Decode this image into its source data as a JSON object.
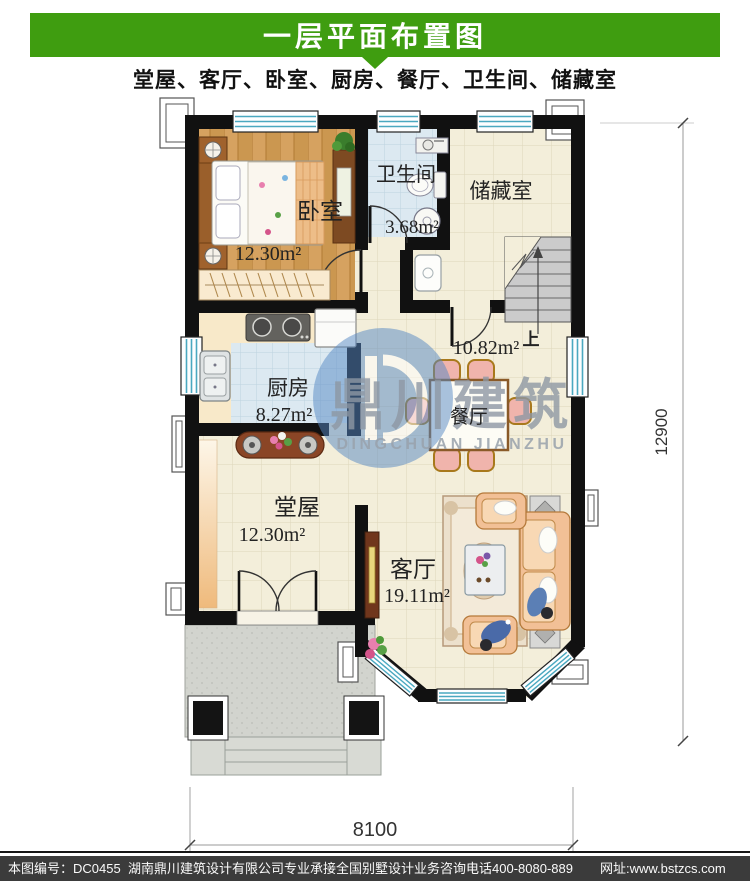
{
  "header": {
    "title": "一层平面布置图",
    "subtitle": "堂屋、客厅、卧室、厨房、餐厅、卫生间、储藏室"
  },
  "rooms": {
    "bedroom": {
      "name": "卧室",
      "area": "12.30m²"
    },
    "bathroom": {
      "name": "卫生间",
      "area": "3.68m²"
    },
    "storage": {
      "name": "储藏室"
    },
    "kitchen": {
      "name": "厨房",
      "area": "8.27m²"
    },
    "dining": {
      "name": "餐厅",
      "area": "10.82m²"
    },
    "hall": {
      "name": "堂屋",
      "area": "12.30m²"
    },
    "living": {
      "name": "客厅",
      "area": "19.11m²"
    },
    "stairs_up": "上"
  },
  "dimensions": {
    "bottom": "8100",
    "right": "12900"
  },
  "watermark": {
    "cn": "鼎川建筑",
    "en": "DINGCHUAN JIANZHU"
  },
  "footer": {
    "plan_no": "本图编号：DC0455",
    "company": "湖南鼎川建筑设计有限公司专业承接全国别墅设计业务",
    "phone": "咨询电话400-8080-889",
    "website": "网址:www.bstzcs.com"
  },
  "colors": {
    "accent_green": "#3f9d10",
    "wall": "#111111",
    "footer_bg": "#3b3b3b",
    "window_teal": "#4aa8c0",
    "floor_cream": "#f3eeda",
    "floor_blue": "#dce9f1",
    "wood": "#d6a260"
  }
}
